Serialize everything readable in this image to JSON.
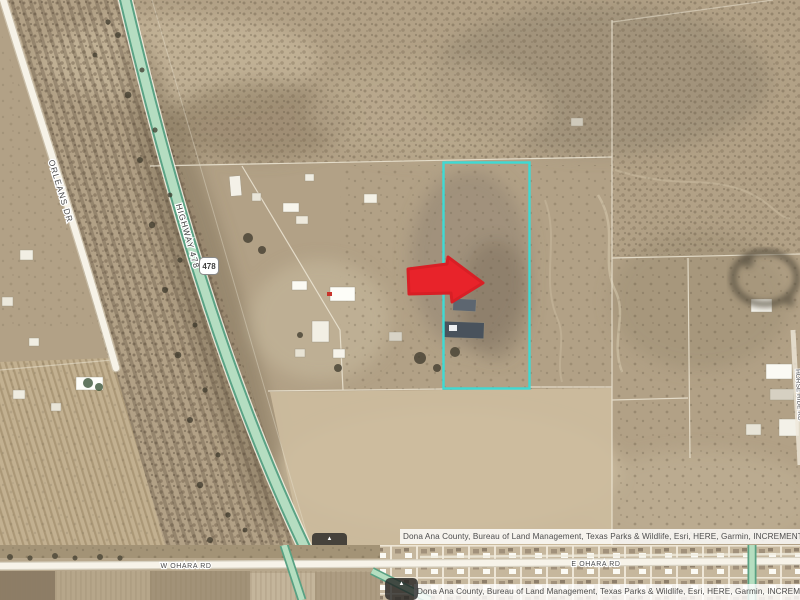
{
  "map_primary": {
    "road_labels": {
      "orleans": "ORLEANS DR",
      "highway": "HIGHWAY 478",
      "highway_shield": "478",
      "horse_ride": "HORSE RIDE RD"
    },
    "parcel_outline_color": "#3EDAD4",
    "arrow_color": "#E8232A",
    "attribution": {
      "text": "Dona Ana County, Bureau of Land Management, Texas Parks & Wildlife, Esri, HERE, Garmin, INCREMENT P, I",
      "expander": "▲"
    }
  },
  "map_secondary": {
    "road_labels": {
      "west": "W OHARA RD",
      "east": "E OHARA RD"
    },
    "attribution": {
      "text": "Dona Ana County, Bureau of Land Management, Texas Parks & Wildlife, Esri, HERE, Garmin, INCREME",
      "expander": "▲"
    }
  }
}
